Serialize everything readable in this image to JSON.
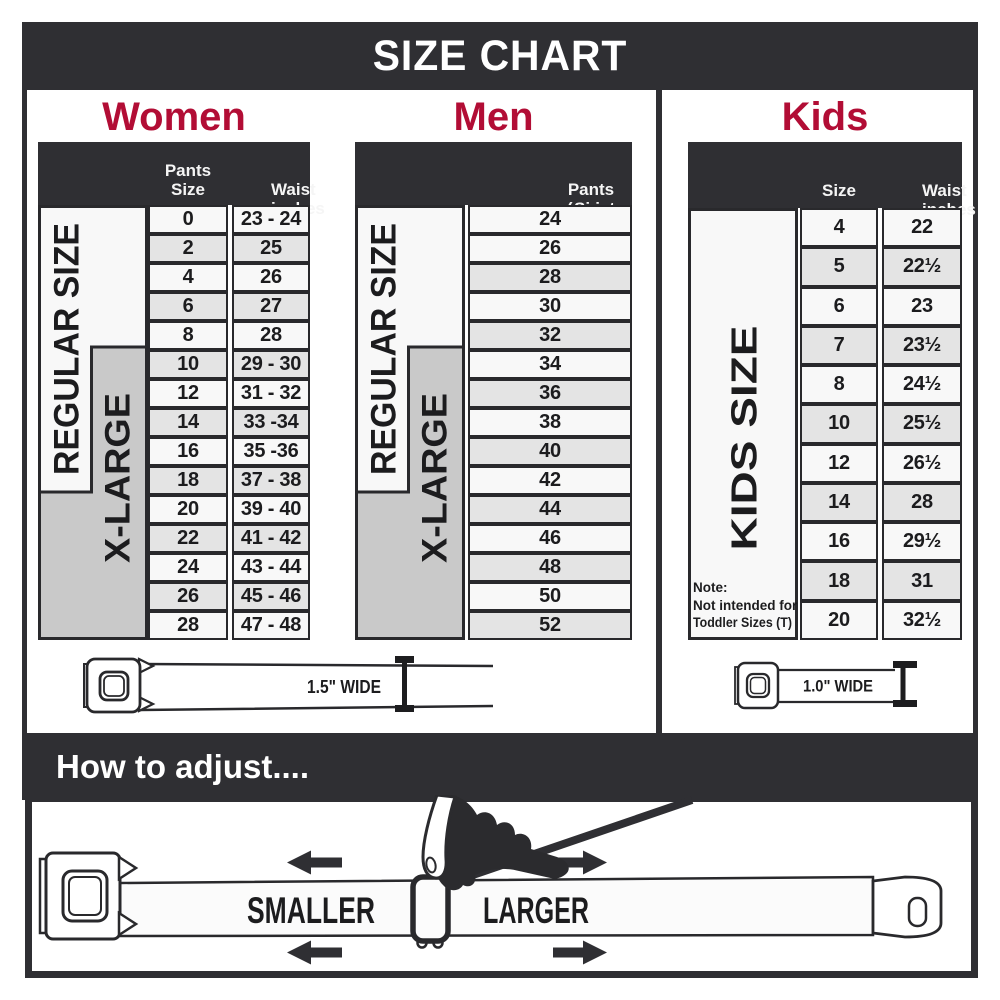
{
  "title": "SIZE CHART",
  "colors": {
    "dark": "#2f2f33",
    "accent": "#b20d35",
    "row_light": "#f8f8f8",
    "row_shaded": "#e4e4e4",
    "label_gray": "#c9c9c9"
  },
  "women": {
    "heading": "Women",
    "col1_header": "Pants Size",
    "col2_header_line1": "Waist",
    "col2_header_line2": "inches",
    "regular_label": "REGULAR SIZE",
    "xlarge_label": "X-LARGE",
    "rows": [
      {
        "size": "0",
        "waist": "23 - 24"
      },
      {
        "size": "2",
        "waist": "25"
      },
      {
        "size": "4",
        "waist": "26"
      },
      {
        "size": "6",
        "waist": "27"
      },
      {
        "size": "8",
        "waist": "28"
      },
      {
        "size": "10",
        "waist": "29 - 30"
      },
      {
        "size": "12",
        "waist": "31 - 32"
      },
      {
        "size": "14",
        "waist": "33 -34"
      },
      {
        "size": "16",
        "waist": "35 -36"
      },
      {
        "size": "18",
        "waist": "37 - 38"
      },
      {
        "size": "20",
        "waist": "39 - 40"
      },
      {
        "size": "22",
        "waist": "41 - 42"
      },
      {
        "size": "24",
        "waist": "43 - 44"
      },
      {
        "size": "26",
        "waist": "45 - 46"
      },
      {
        "size": "28",
        "waist": "47 - 48"
      }
    ]
  },
  "men": {
    "heading": "Men",
    "col_header_line1": "Pants Size",
    "col_header_line2": "(waist inches)",
    "regular_label": "REGULAR SIZE",
    "xlarge_label": "X-LARGE",
    "rows": [
      "24",
      "26",
      "28",
      "30",
      "32",
      "34",
      "36",
      "38",
      "40",
      "42",
      "44",
      "46",
      "48",
      "50",
      "52"
    ]
  },
  "kids": {
    "heading": "Kids",
    "col1_header": "Size",
    "col2_header_line1": "Waist",
    "col2_header_line2": "inches",
    "label": "KIDS SIZE",
    "note_line1": "Note:",
    "note_line2": "Not intended for",
    "note_line3": "Toddler Sizes (T)",
    "rows": [
      {
        "size": "4",
        "waist": "22"
      },
      {
        "size": "5",
        "waist": "22½"
      },
      {
        "size": "6",
        "waist": "23"
      },
      {
        "size": "7",
        "waist": "23½"
      },
      {
        "size": "8",
        "waist": "24½"
      },
      {
        "size": "10",
        "waist": "25½"
      },
      {
        "size": "12",
        "waist": "26½"
      },
      {
        "size": "14",
        "waist": "28"
      },
      {
        "size": "16",
        "waist": "29½"
      },
      {
        "size": "18",
        "waist": "31"
      },
      {
        "size": "20",
        "waist": "32½"
      }
    ]
  },
  "belts": {
    "adult_width_label": "1.5\" WIDE",
    "kids_width_label": "1.0\" WIDE"
  },
  "footer": {
    "heading": "How to adjust....",
    "smaller_label": "SMALLER",
    "larger_label": "LARGER"
  }
}
